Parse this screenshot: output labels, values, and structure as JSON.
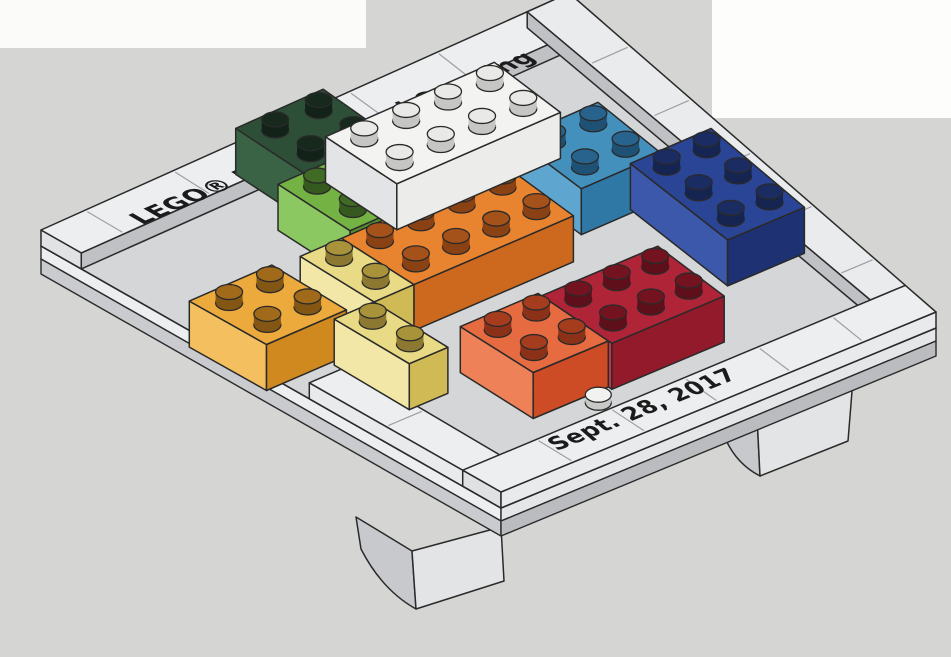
{
  "texts": {
    "back_edge": "LEGO® House Grand Opening",
    "front_edge": "Sept. 28, 2017"
  },
  "scene": {
    "background": {
      "base_color": "#d5d5d3",
      "patches": [
        {
          "name": "white-scan-band-top-left",
          "x": 0,
          "y": 0,
          "w": 366,
          "h": 48,
          "color": "#fbfbf9"
        },
        {
          "name": "white-scan-patch-top-right",
          "x": 712,
          "y": 0,
          "w": 239,
          "h": 118,
          "color": "#fdfdfc"
        }
      ]
    },
    "corners": {
      "L": [
        41,
        246
      ],
      "T": [
        569,
        9
      ],
      "R": [
        936,
        328
      ],
      "F": [
        501,
        508
      ]
    },
    "metrics": {
      "grid": 12,
      "brick_h": 46,
      "rim_h": 16,
      "stud_h": 11,
      "stud_rx": 13.5,
      "stud_ry": 7.5,
      "outline": "#2a2a2a"
    },
    "table": {
      "top": "#d4d6d8",
      "lf_band1": "#eceef0",
      "lf_band2": "#c9cbce",
      "fr_band1": "#e4e6e8",
      "fr_band2": "#babcbf",
      "band1_h": 13,
      "band2_h": 28
    },
    "legs": [
      {
        "name": "front-left-leg",
        "front": [
          [
            412,
            551
          ],
          [
            501,
            527
          ],
          [
            504,
            581
          ],
          [
            416,
            609
          ]
        ],
        "flank": "M356,517 L412,551 L416,609 Q382,590 361,549 Z",
        "front_color": "#e3e4e6",
        "flank_color": "#c7c9cc"
      },
      {
        "name": "front-right-leg",
        "front": [
          [
            757,
            416
          ],
          [
            853,
            379
          ],
          [
            848,
            441
          ],
          [
            760,
            476
          ]
        ],
        "flank": "M723,418 L757,416 L760,476 Q737,464 726,440 Z",
        "front_color": "#e3e4e6",
        "flank_color": "#c7c9cc"
      }
    ],
    "rims": [
      {
        "name": "back-edge-tiles",
        "q": 0,
        "r": 0,
        "wq": 12,
        "wr": 1.05,
        "colors": {
          "top": "#eceef0",
          "left": "#e0e2e4",
          "right": "#bfc1c4"
        },
        "sep_axis": "q",
        "sep": [
          1,
          3,
          5,
          7,
          9,
          11
        ]
      },
      {
        "name": "right-edge-tiles",
        "q": 11.05,
        "r": 0,
        "wq": 0.95,
        "wr": 11,
        "colors": {
          "top": "#e9ebed",
          "left": "#bfc1c4",
          "right": "#e0e2e4"
        },
        "sep_axis": "r",
        "sep": [
          2,
          4,
          6,
          8,
          10
        ]
      },
      {
        "name": "left-edge-tiles",
        "q": 0,
        "r": 7,
        "wq": 1,
        "wr": 5,
        "colors": {
          "top": "#eceef0",
          "left": "#e8eaec",
          "right": "#c9cbcd"
        },
        "sep_axis": "r",
        "sep": [
          9,
          11
        ]
      },
      {
        "name": "front-edge-tiles",
        "q": 0,
        "r": 11,
        "wq": 12,
        "wr": 1,
        "colors": {
          "top": "#eceef0",
          "left": "#dfe1e3",
          "right": "#e8eaec"
        },
        "sep_axis": "q",
        "sep": [
          2,
          4,
          6,
          8,
          10
        ]
      }
    ],
    "brick_colors": {
      "white": {
        "top": "#f3f3f1",
        "left": "#e3e4e6",
        "right": "#ececea",
        "studTop": "#e9e9e7",
        "studSide": "#c6c7c5"
      },
      "dark_green": {
        "top": "#2e4f37",
        "left": "#3a6345",
        "right": "#1f3b28",
        "studTop": "#16291c",
        "studSide": "#122218"
      },
      "bright_green": {
        "top": "#74b244",
        "left": "#8cc862",
        "right": "#568f31",
        "studTop": "#3f6b24",
        "studSide": "#35591e"
      },
      "azure": {
        "top": "#4490bd",
        "left": "#5ea6cf",
        "right": "#2f77a4",
        "studTop": "#27638c",
        "studSide": "#1f5174"
      },
      "dark_blue": {
        "top": "#2a4596",
        "left": "#3c58ab",
        "right": "#1e3173",
        "studTop": "#1a2c62",
        "studSide": "#152450"
      },
      "orange": {
        "top": "#e8842f",
        "left": "#f19a4e",
        "right": "#cd691e",
        "studTop": "#a4511a",
        "studSide": "#8a4113"
      },
      "yellow_orange": {
        "top": "#ecaa3c",
        "left": "#f4c05f",
        "right": "#d0891f",
        "studTop": "#a06a1a",
        "studSide": "#845614"
      },
      "pale_yellow": {
        "top": "#e9da85",
        "left": "#f2e7a6",
        "right": "#d0ba55",
        "studTop": "#a8923a",
        "studSide": "#8c7830"
      },
      "coral": {
        "top": "#e76b41",
        "left": "#ef8159",
        "right": "#cd4b25",
        "studTop": "#a63c1e",
        "studSide": "#8b3118"
      },
      "dark_red": {
        "top": "#b02437",
        "left": "#c23848",
        "right": "#931a2a",
        "studTop": "#731320",
        "studSide": "#5e0f1a"
      }
    },
    "bricks": [
      {
        "name": "azure-brick-2x2",
        "color": "azure",
        "q": 7.9,
        "r": 3.8,
        "wq": 2,
        "wr": 2,
        "lvl": 0
      },
      {
        "name": "dark-green-brick-2x2",
        "color": "dark_green",
        "q": 4.1,
        "r": 0.4,
        "wq": 2,
        "wr": 2,
        "lvl": 0
      },
      {
        "name": "dark-blue-brick-2x3",
        "color": "dark_blue",
        "q": 9.2,
        "r": 5.7,
        "wq": 2,
        "wr": 3,
        "lvl": 0
      },
      {
        "name": "bright-green-brick-2x2",
        "color": "bright_green",
        "q": 3.5,
        "r": 2.3,
        "wq": 2,
        "wr": 2,
        "lvl": 0
      },
      {
        "name": "orange-brick-2x4",
        "color": "orange",
        "q": 3.2,
        "r": 4.4,
        "wq": 4,
        "wr": 2,
        "lvl": 0
      },
      {
        "name": "pale-yellow-brick-1x2-rear",
        "color": "pale_yellow",
        "q": 2.2,
        "r": 4.4,
        "wq": 1,
        "wr": 2,
        "lvl": 0
      },
      {
        "name": "dark-red-brick-2x3",
        "color": "dark_red",
        "q": 4.9,
        "r": 8.1,
        "wq": 3,
        "wr": 2,
        "lvl": 0
      },
      {
        "name": "yellow-orange-brick-2x2",
        "color": "yellow_orange",
        "q": -0.4,
        "r": 4.3,
        "wq": 2,
        "wr": 2,
        "lvl": 0
      },
      {
        "name": "coral-brick-2x2",
        "color": "coral",
        "q": 2.9,
        "r": 8.0,
        "wq": 2,
        "wr": 2,
        "lvl": 0
      },
      {
        "name": "pale-yellow-brick-1x2-front",
        "color": "pale_yellow",
        "q": 1.2,
        "r": 6.4,
        "wq": 1,
        "wr": 2,
        "lvl": 0
      },
      {
        "name": "white-brick-2x4",
        "color": "white",
        "q": 4.2,
        "r": 2.8,
        "wq": 4,
        "wr": 2,
        "lvl": 1
      }
    ],
    "keystone": {
      "name": "keystone-round-plate-1x1",
      "q": 4.35,
      "r": 10.3,
      "h": 8,
      "top": "#f2f2f0",
      "side": "#c8c9c7"
    }
  }
}
